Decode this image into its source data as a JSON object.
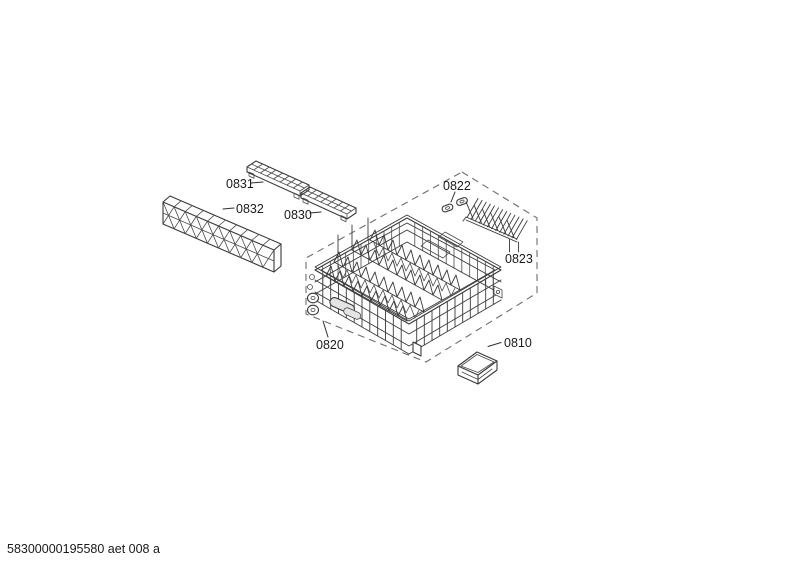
{
  "diagram": {
    "callouts": [
      {
        "part": "0831"
      },
      {
        "part": "0832"
      },
      {
        "part": "0830"
      },
      {
        "part": "0822"
      },
      {
        "part": "0823"
      },
      {
        "part": "0820"
      },
      {
        "part": "0810"
      }
    ],
    "footer_code": "58300000195580 aet 008 a"
  },
  "colors": {
    "background": "#ffffff",
    "line": "#3a3a3a",
    "dashed_outline": "#6e6e6e",
    "label_text": "#1a1a1a"
  }
}
